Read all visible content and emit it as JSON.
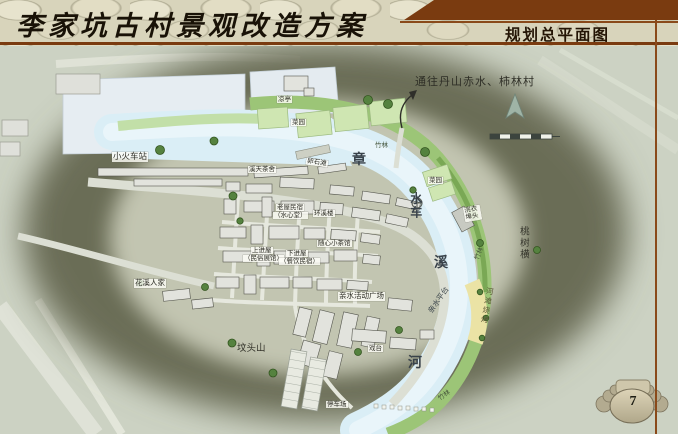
{
  "header": {
    "left_title": "李家坑古村景观改造方案",
    "right_title": "规划总平面图"
  },
  "map": {
    "direction_note": "通往丹山赤水、柿林村",
    "river_name_chars": [
      "章",
      "水车",
      "溪",
      "河"
    ],
    "labels": [
      {
        "text": "小火车站"
      },
      {
        "text": "凉亭"
      },
      {
        "text": "菜园"
      },
      {
        "text": "菜园"
      },
      {
        "text": "竹林"
      },
      {
        "text": "竹林"
      },
      {
        "text": "竹林"
      },
      {
        "text": "溪天茶舍"
      },
      {
        "text": "卵石滩"
      },
      {
        "text": "浣衣埠头"
      },
      {
        "text": "老屋民宿"
      },
      {
        "text": "（水心堂）"
      },
      {
        "text": "环溪楼"
      },
      {
        "text": "上进屋"
      },
      {
        "text": "（民俗展馆）"
      },
      {
        "text": "下进屋"
      },
      {
        "text": "（餐饮民宿）"
      },
      {
        "text": "随心小茶馆"
      },
      {
        "text": "花溪人家"
      },
      {
        "text": "亲水活动广场"
      },
      {
        "text": "亲水平台"
      },
      {
        "text": "河滩烧烤"
      },
      {
        "text": "坟头山"
      },
      {
        "text": "停车场"
      },
      {
        "text": "戏台"
      },
      {
        "text": "桃树横"
      }
    ]
  },
  "page": {
    "number": "7"
  },
  "icons": {
    "north_arrow": "north-arrow-icon",
    "scale_bar": "scale-bar-icon",
    "route_arrow": "route-arrow-icon",
    "page_emblem": "winged-stone-emblem-icon",
    "waterwheel": "waterwheel-icon"
  },
  "colors": {
    "accent_brown": "#7a3b10",
    "river_blue": "#daeef6",
    "bamboo_green": "#9cc577",
    "field_green": "#cfe6b2",
    "sand_yellow": "#ebe3a5",
    "hill_olive": "#6b6d56",
    "stone_beige": "#d8d4bb"
  }
}
